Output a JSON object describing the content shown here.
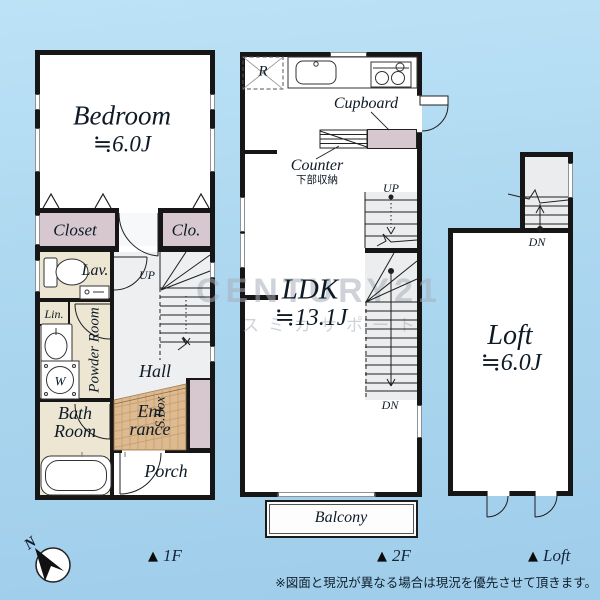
{
  "meta": {
    "kind": "real-estate floor plan"
  },
  "colors": {
    "background": "#aed8f0",
    "wall": "#161616",
    "closet_fill": "#d6c8ce",
    "wet_room_fill": "#ece6d3",
    "hall_fill": "#edeff0",
    "stair_fill": "#ebedee",
    "entrance_fill": "#ddba90",
    "window_gray": "#8d9398",
    "label_navy": "#14243a"
  },
  "floor1": {
    "marker_triangle": "▲",
    "marker": "1F",
    "bedroom_name": "Bedroom",
    "bedroom_area": "≒6.0J",
    "closet": "Closet",
    "clo": "Clo.",
    "lav": "Lav.",
    "lin": "Lin.",
    "powder": "Powder Room",
    "washer": "W",
    "bath_line1": "Bath",
    "bath_line2": "Room",
    "hall": "Hall",
    "up": "UP",
    "entrance_line1": "Ent",
    "entrance_line2": "rance",
    "sbox": "S.Box",
    "porch": "Porch"
  },
  "floor2": {
    "marker_triangle": "▲",
    "marker": "2F",
    "fridge": "R",
    "cupboard": "Cupboard",
    "counter": "Counter",
    "counter_sub": "下部収納",
    "ldk_name": "LDK",
    "ldk_area": "≒13.1J",
    "up": "UP",
    "dn": "DN",
    "balcony": "Balcony"
  },
  "loft": {
    "marker_triangle": "▲",
    "marker": "Loft",
    "name": "Loft",
    "area": "≒6.0J",
    "dn": "DN"
  },
  "compass": {
    "label": "N"
  },
  "watermark": {
    "brand": "CENTURY21",
    "sub": "スミカサポート"
  },
  "disclaimer": "※図面と現況が異なる場合は現況を優先させて頂きます。"
}
